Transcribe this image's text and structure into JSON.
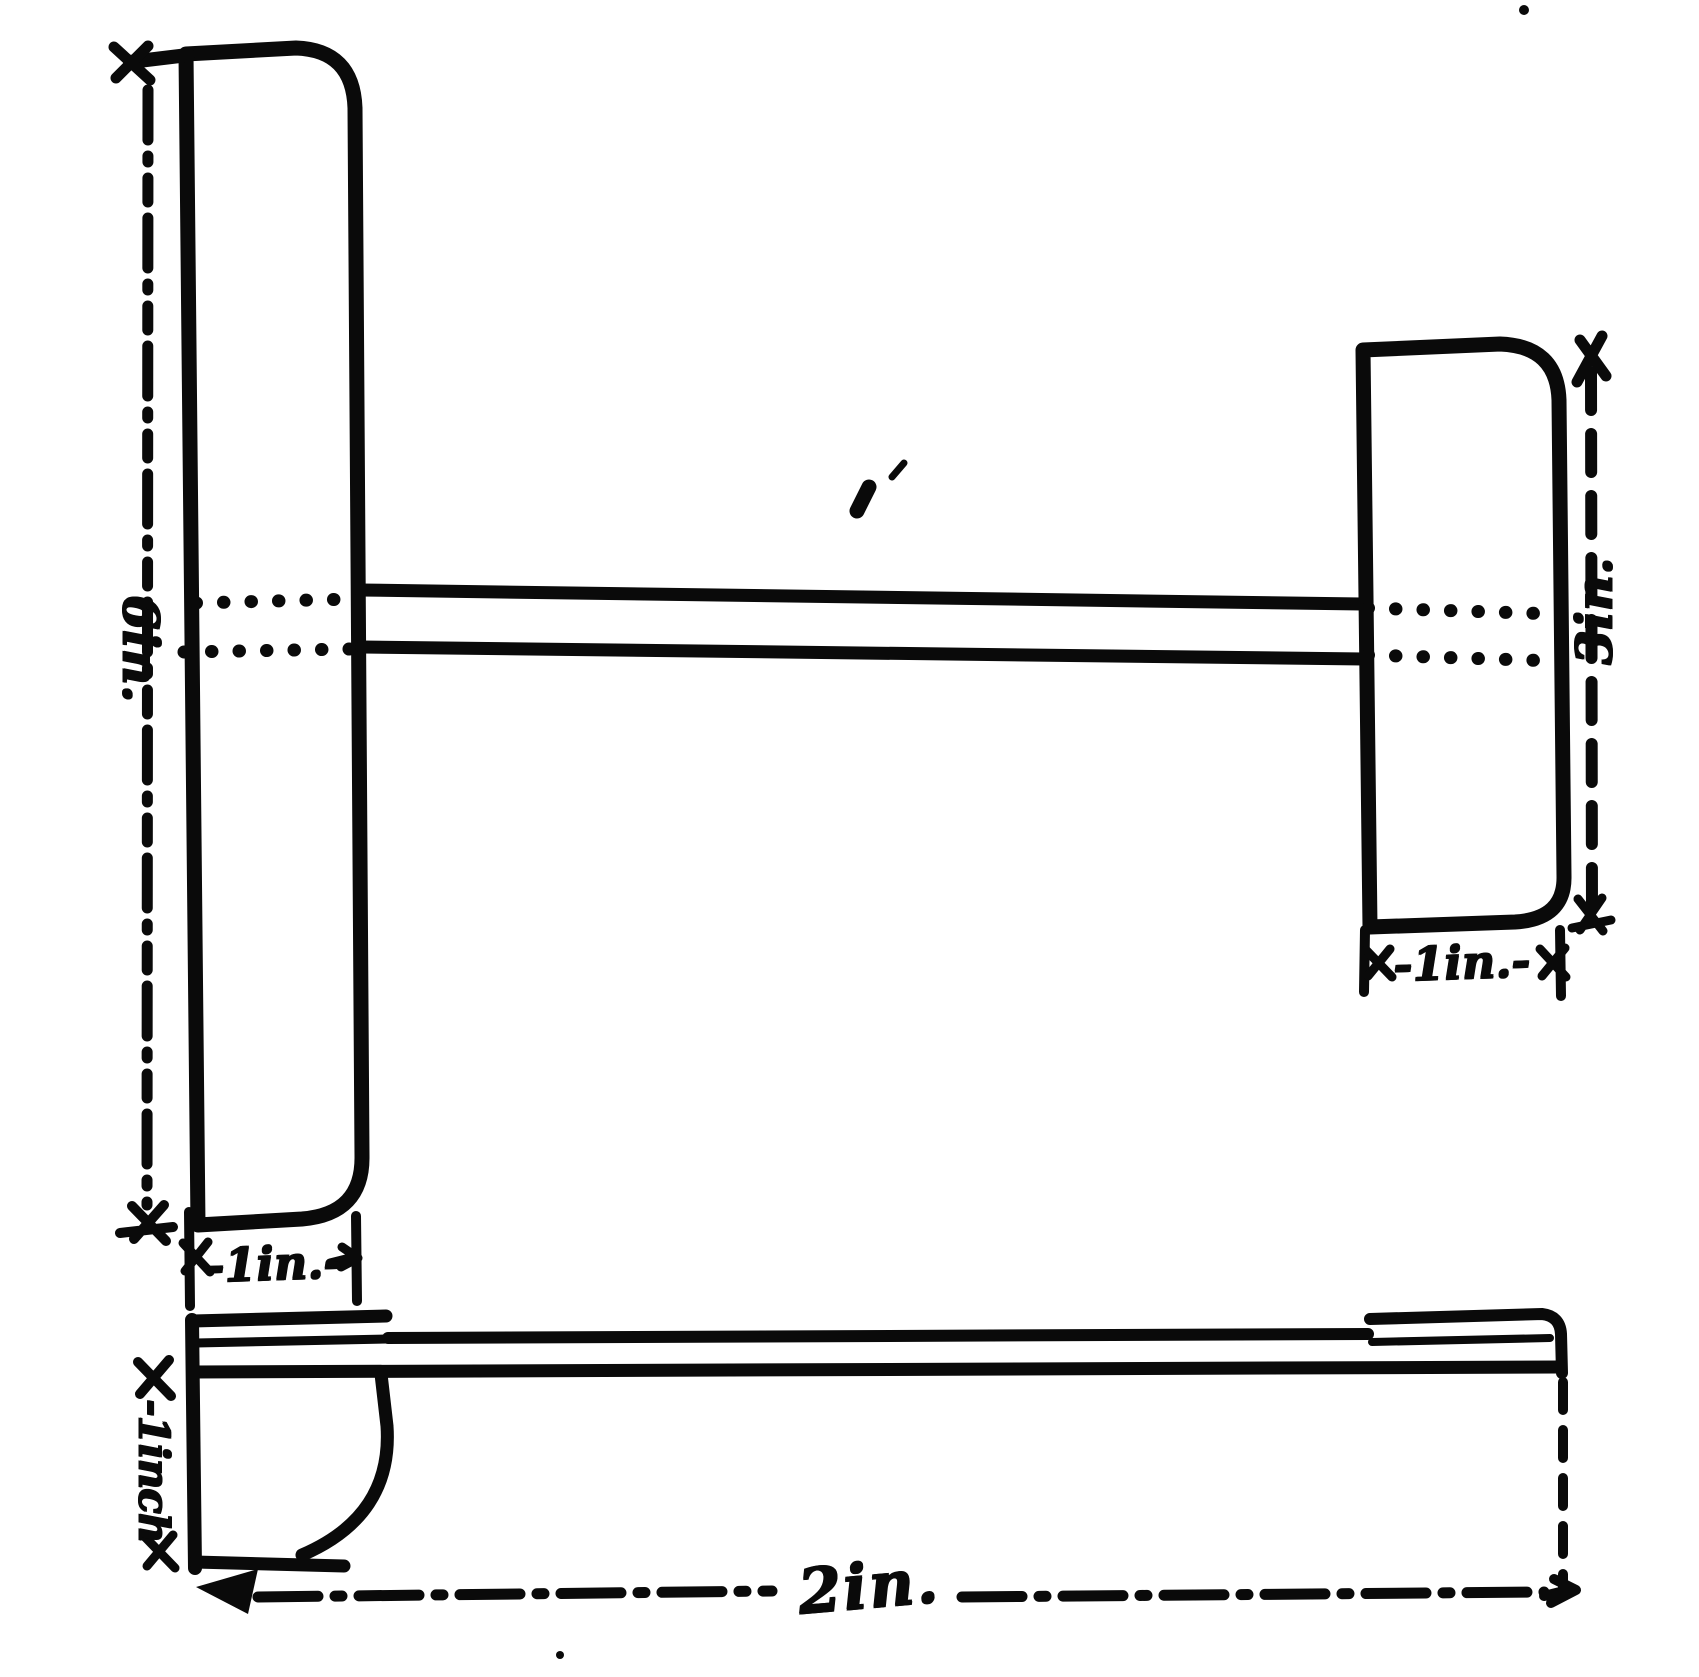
{
  "figure": {
    "description": "Hand-inked dimensioned sketch: plan view of a long stick carrying a large plane (left) and a small plane (right), with a side elevation below",
    "ink_color": "#0a0a0a",
    "paper_color": "#ffffff"
  },
  "dimensions": {
    "main_plane_height": "6in.",
    "main_plane_width": "-1in.-",
    "tail_plane_height": "3in.",
    "tail_plane_width": "-1in.-",
    "side_front_depth": "-1inch",
    "total_length": "2in."
  }
}
